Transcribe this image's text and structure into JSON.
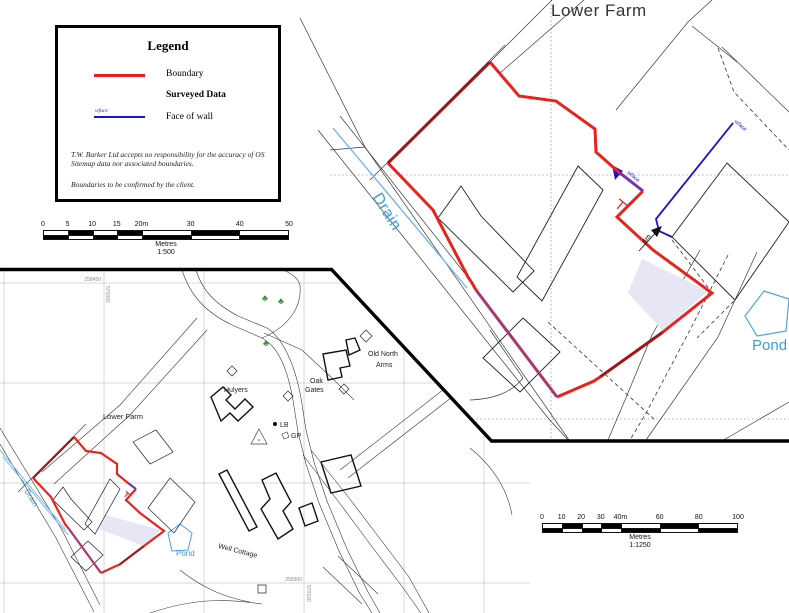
{
  "title": "Lower Farm",
  "legend": {
    "title": "Legend",
    "boundary_label": "Boundary",
    "surveyed_heading": "Surveyed Data",
    "wall_label": "Face of wall",
    "wall_annotation": "wface",
    "disclaimer_1": "T.W. Barker Ltd accepts no responsibility for the accuracy of OS Sitemap data nor associated boundaries.",
    "disclaimer_2": "Boundaries to be confirmed by the client."
  },
  "scalebar_500": {
    "ticks": [
      "0",
      "5",
      "10",
      "15",
      "20m",
      "30",
      "40",
      "50"
    ],
    "unit": "Metres",
    "ratio": "1:500"
  },
  "scalebar_1250": {
    "ticks": [
      "0",
      "10",
      "20",
      "30",
      "40m",
      "60",
      "80",
      "100"
    ],
    "unit": "Metres",
    "ratio": "1:1250"
  },
  "main_map": {
    "labels": {
      "drain": "Drain",
      "pond": "Pond",
      "wface_1": "wface",
      "wface_2": "wface",
      "dim_4m": "4m"
    }
  },
  "overview_map": {
    "labels": {
      "lower_farm": "Lower Farm",
      "hulyers": "Hulyers",
      "oak": "Oak",
      "gates": "Gates",
      "old_north": "Old North",
      "arms": "Arms",
      "lb": "LB",
      "gp": "GP",
      "well_cottage": "Well Cottage",
      "drain": "Drain",
      "pond": "Pond"
    },
    "grid": {
      "northing_top": "258450",
      "easting_top": "570000",
      "northing_bottom": "258300",
      "easting_bottom": "570100"
    }
  },
  "colors": {
    "boundary": "#e8231c",
    "boundary_over_os": "#a31515",
    "face_of_wall": "#1a16c8",
    "boundary_over_wall": "#7a2fae",
    "boundary_over_drain": "#a8386e",
    "water_line": "#6ab2ee",
    "water_label": "#3d9be0",
    "shading": "#e6e6f5",
    "tree": "#3d8b3d"
  }
}
